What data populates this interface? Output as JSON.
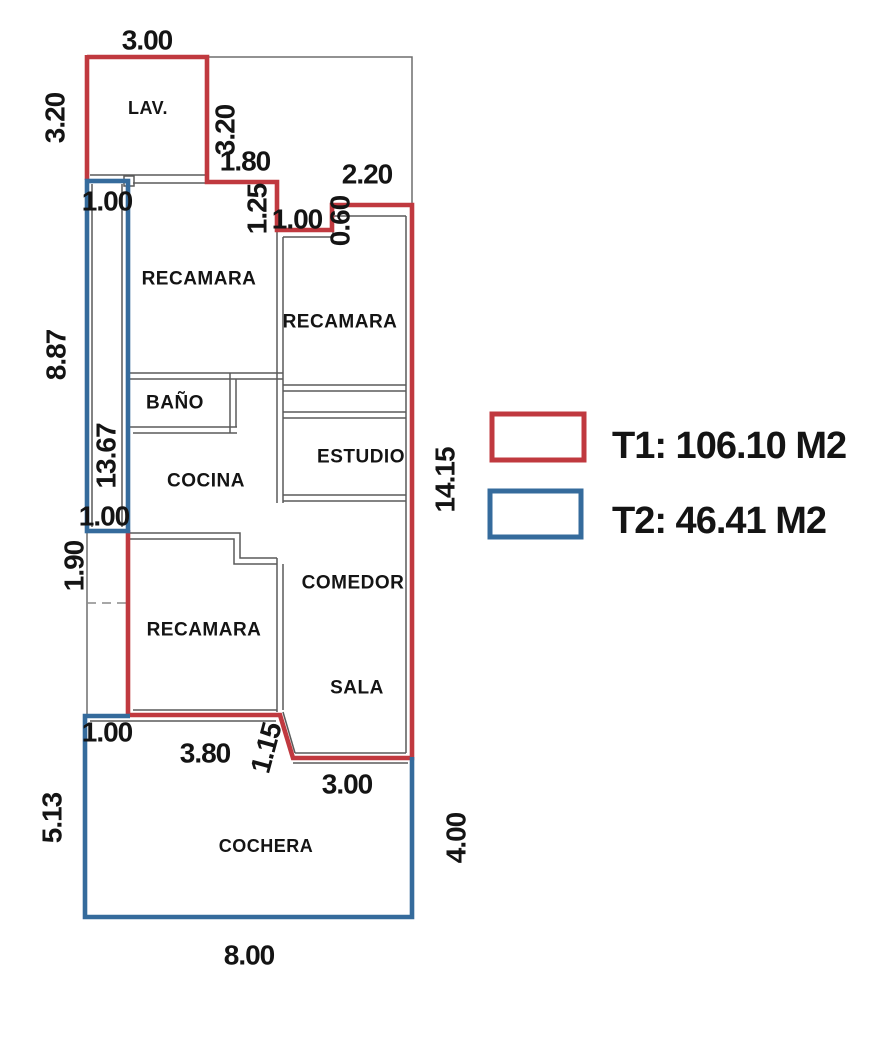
{
  "legend": {
    "t1_label": "T1: 106.10 M2",
    "t2_label": "T2: 46.41 M2"
  },
  "rooms": {
    "lav": "LAV.",
    "recamara_nw": "RECAMARA",
    "recamara_ne": "RECAMARA",
    "bano": "BAÑO",
    "estudio": "ESTUDIO",
    "cocina": "COCINA",
    "comedor": "COMEDOR",
    "sala": "SALA",
    "recamara_s": "RECAMARA",
    "cochera": "COCHERA"
  },
  "dimensions": {
    "top_3_00": "3.00",
    "lav_left_3_20": "3.20",
    "lav_right_3_20": "3.20",
    "h_1_80": "1.80",
    "v_1_25": "1.25",
    "h_2_20": "2.20",
    "h_1_00_step": "1.00",
    "v_0_60": "0.60",
    "strip_top_1_00": "1.00",
    "left_8_87": "8.87",
    "strip_13_67": "13.67",
    "right_14_15": "14.15",
    "strip_bot_1_00": "1.00",
    "left_1_90": "1.90",
    "coch_1_00": "1.00",
    "bot_3_80": "3.80",
    "diag_1_15": "1.15",
    "bot_3_00": "3.00",
    "coch_5_13": "5.13",
    "coch_4_00": "4.00",
    "coch_8_00": "8.00"
  },
  "colors": {
    "t1_red": "#c0393f",
    "t2_blue": "#356b9c",
    "wall_gray": "#5a5a5a",
    "lot_gray": "#6e6e6e",
    "dash_gray": "#8a8a8a"
  }
}
